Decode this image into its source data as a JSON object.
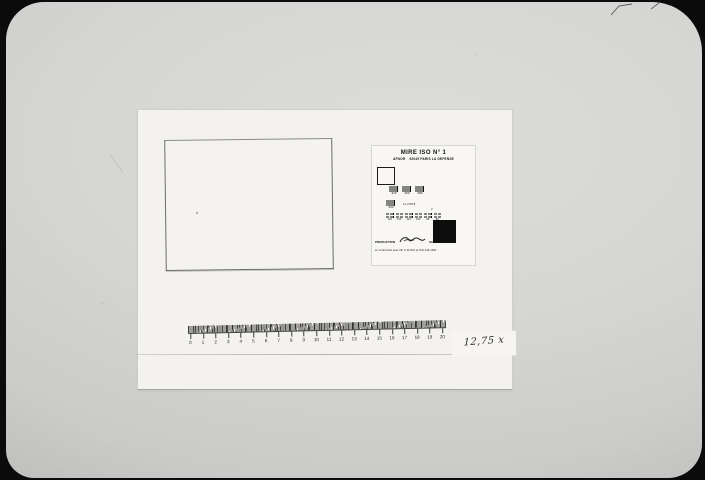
{
  "colors": {
    "surround": "#0b0b0b",
    "photo_paper": "#d2d2d0",
    "sheet_white": "#f3f2ef",
    "chart_card": "#f8f7f4",
    "chart_ink": "#141414",
    "ruler_ink": "#3c3c3a"
  },
  "test_chart": {
    "title": "MIRE ISO N° 1",
    "org": "AFNOR",
    "address": "92049 PARIS LA DEFENSE",
    "pattern_row_top": [
      {
        "label": "315"
      },
      {
        "label": "250"
      },
      {
        "label": "280"
      }
    ],
    "pattern_row_mid": {
      "left_label": "200",
      "right_text": "112888",
      "right_sub": "2"
    },
    "pattern_row_bottom": [
      {
        "label": "140"
      },
      {
        "label": "125"
      },
      {
        "label": "112"
      },
      {
        "label": "100"
      },
      {
        "label": "90"
      },
      {
        "label": "80"
      }
    ],
    "footer_production": "PRODUCTION",
    "footer_maker": "SCRIPTUM PARIS",
    "footer_note": "en conformité avec NF Z 43-010 et ISO 446-1991"
  },
  "ruler": {
    "numbers": [
      "0",
      "1",
      "2",
      "3",
      "4",
      "5",
      "6",
      "7",
      "8",
      "9",
      "10",
      "11",
      "12",
      "13",
      "14",
      "15",
      "16",
      "17",
      "18",
      "19",
      "20"
    ]
  },
  "annotation": {
    "text": "12,75 x"
  }
}
